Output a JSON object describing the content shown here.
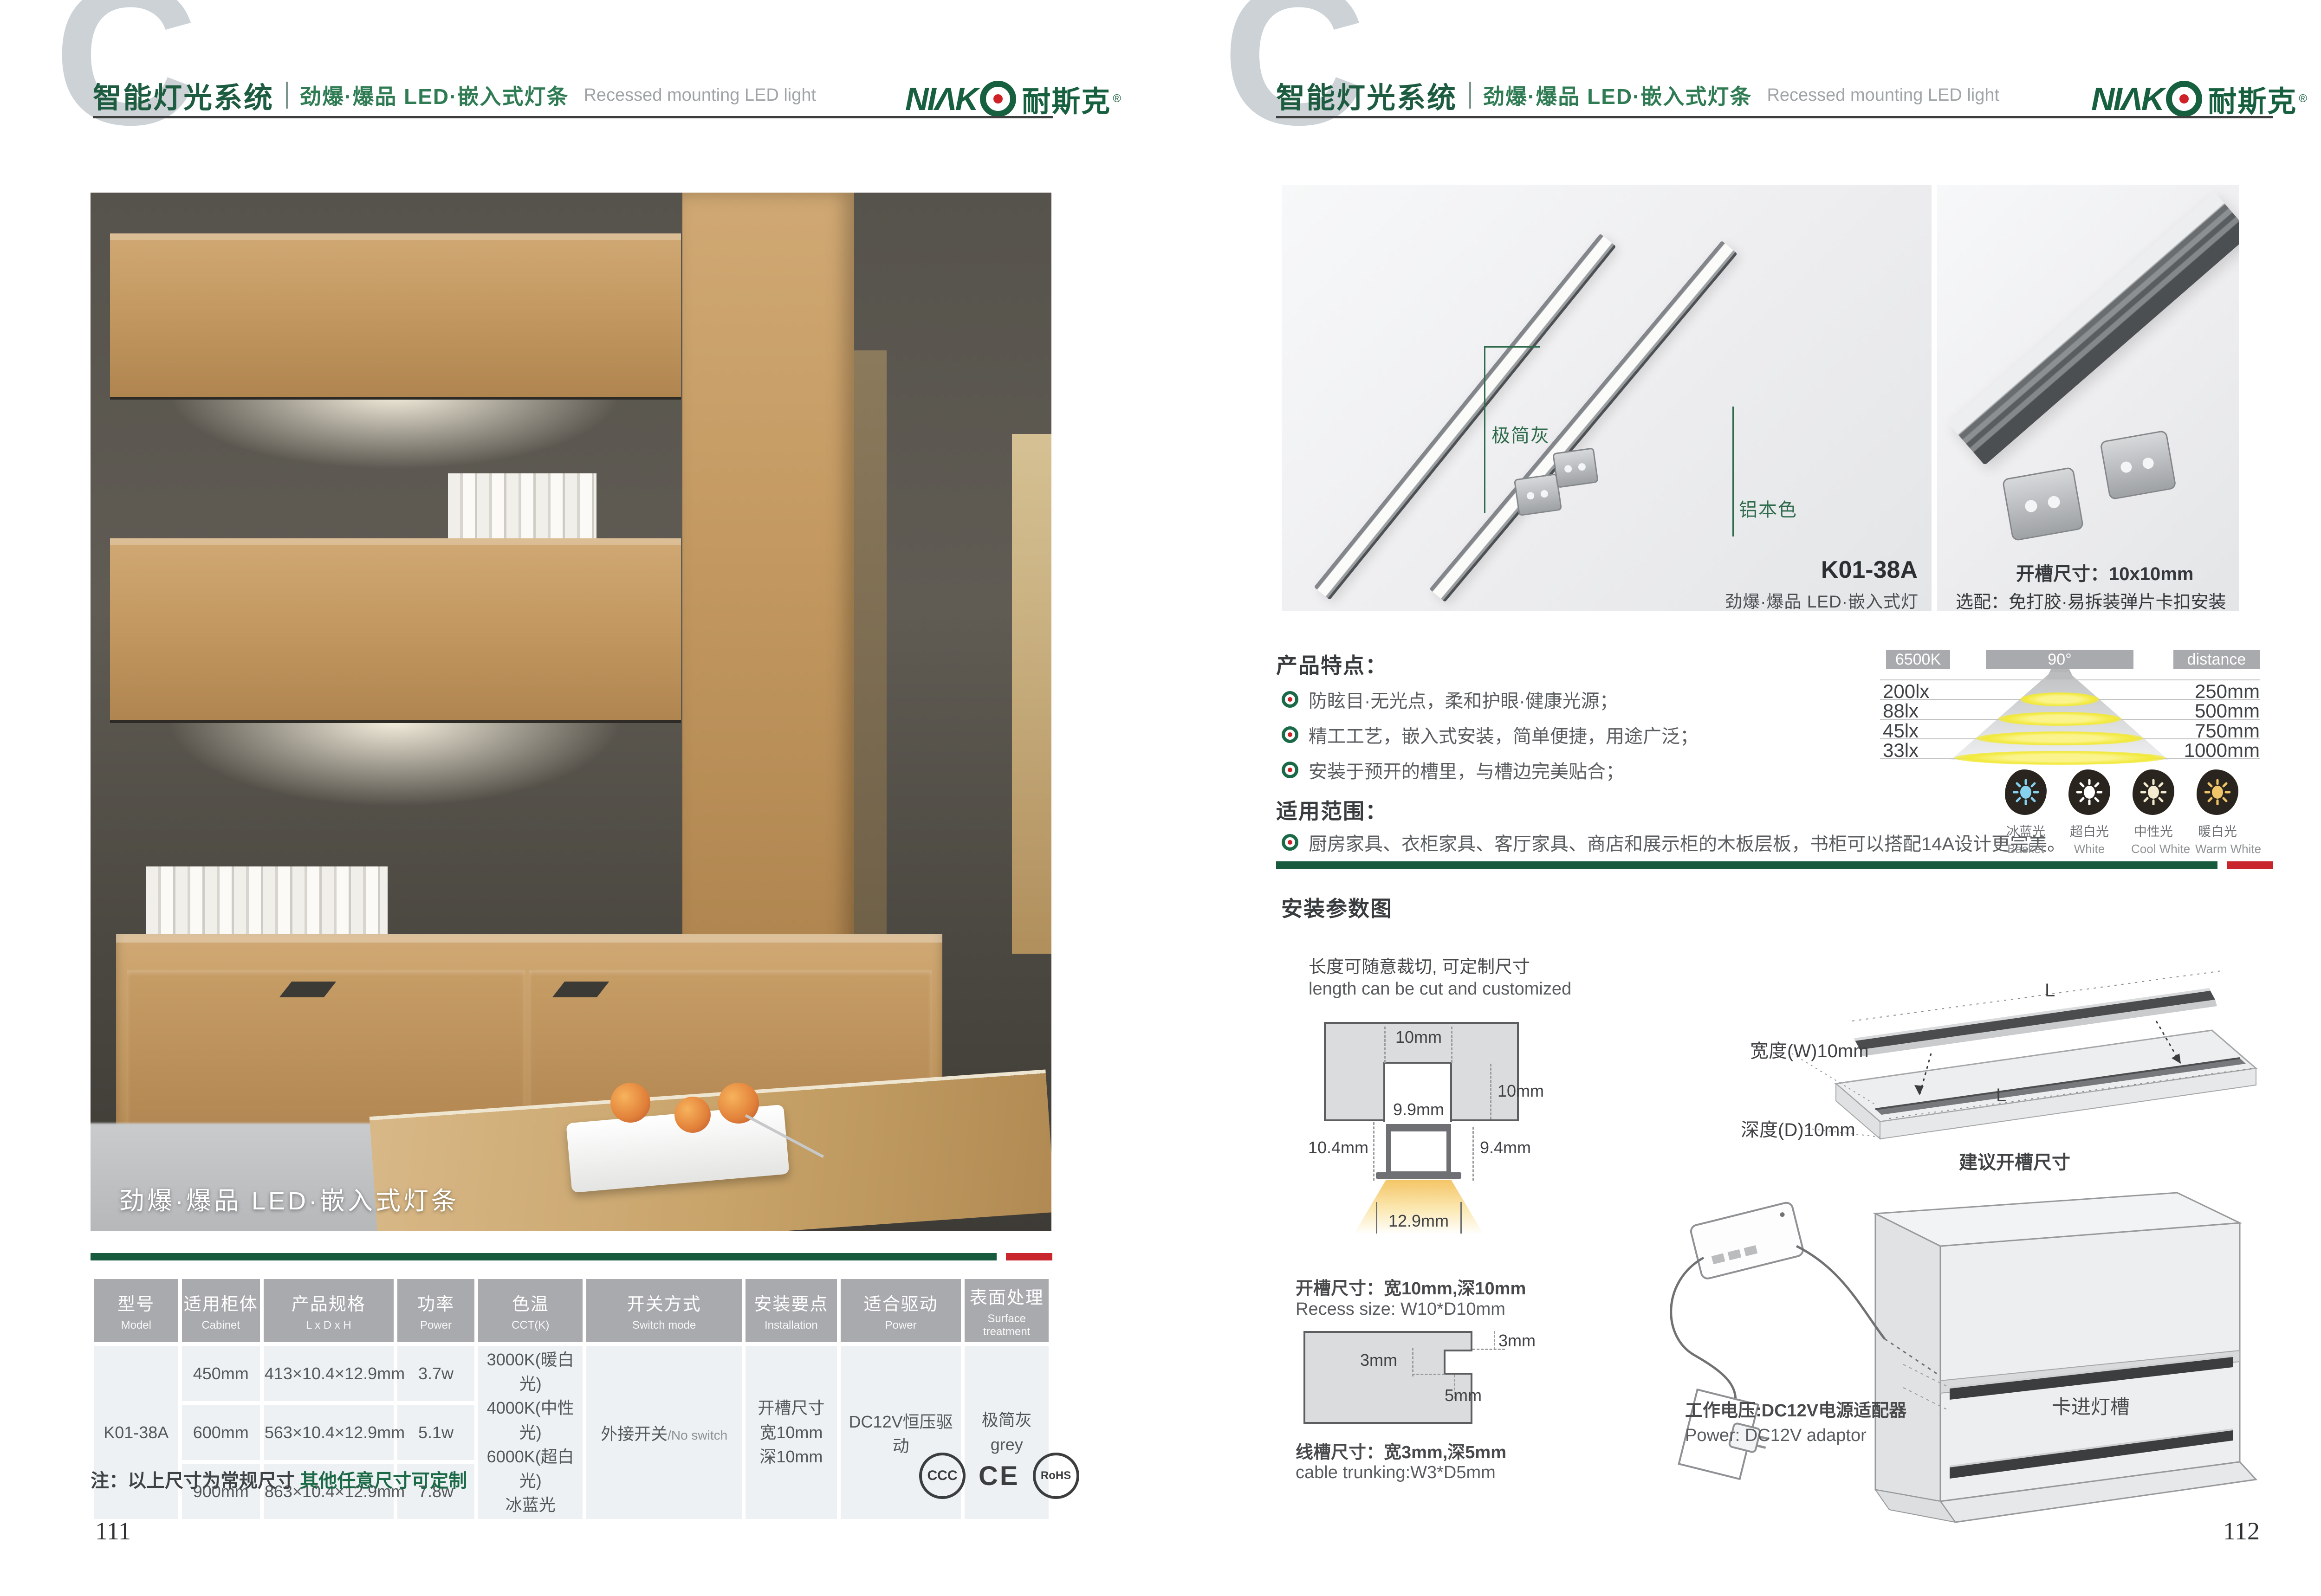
{
  "header": {
    "watermark_letter": "C",
    "title_cn": "智能灯光系统",
    "subtitle_cn": "劲爆·爆品  LED·嵌入式灯条",
    "subtitle_en": "Recessed mounting LED light",
    "brand_latin": "NIΛK",
    "brand_cn": "耐斯克",
    "brand_reg": "®"
  },
  "colors": {
    "brand_green": "#1b6a47",
    "accent_red": "#c9252c",
    "bar_green": "#175a3e",
    "table_header_gray": "#a8aaad"
  },
  "left_page": {
    "page_number": "111",
    "photo_caption": "劲爆·爆品  LED·嵌入式灯条",
    "note_prefix": "注：以上尺寸为常规尺寸 ",
    "note_highlight": "其他任意尺寸可定制",
    "certs": {
      "ccc": "CCC",
      "ce": "CE",
      "rohs": "RoHS"
    },
    "table": {
      "headers": [
        {
          "cn": "型号",
          "en": "Model"
        },
        {
          "cn": "适用柜体",
          "en": "Cabinet"
        },
        {
          "cn": "产品规格",
          "en": "L x D x H"
        },
        {
          "cn": "功率",
          "en": "Power"
        },
        {
          "cn": "色温",
          "en": "CCT(K)"
        },
        {
          "cn": "开关方式",
          "en": "Switch mode"
        },
        {
          "cn": "安装要点",
          "en": "Installation"
        },
        {
          "cn": "适合驱动",
          "en": "Power"
        },
        {
          "cn": "表面处理",
          "en": "Surface treatment"
        }
      ],
      "model": "K01-38A",
      "rows": [
        {
          "cabinet": "450mm",
          "size": "413×10.4×12.9mm",
          "power": "3.7w"
        },
        {
          "cabinet": "600mm",
          "size": "563×10.4×12.9mm",
          "power": "5.1w"
        },
        {
          "cabinet": "900mm",
          "size": "863×10.4×12.9mm",
          "power": "7.8w"
        }
      ],
      "cct_lines": [
        "3000K(暖白光)",
        "4000K(中性光)",
        "6000K(超白光)",
        "冰蓝光"
      ],
      "switch_cn": "外接开关",
      "switch_en": "/No switch",
      "install_lines": [
        "开槽尺寸",
        "宽10mm",
        "深10mm"
      ],
      "driver": "DC12V恒压驱动",
      "surface_cn": "极简灰",
      "surface_en": "grey"
    }
  },
  "right_page": {
    "page_number": "112",
    "photo_main": {
      "label_grey": "极简灰",
      "label_aluminum": "铝本色",
      "model": "K01-38A",
      "caption": "劲爆·爆品  LED·嵌入式灯条"
    },
    "photo_detail": {
      "line1": "开槽尺寸：10x10mm",
      "line2": "选配：免打胶·易拆装弹片卡扣安装"
    },
    "features": {
      "title": "产品特点：",
      "items": [
        "防眩目·无光点，柔和护眼·健康光源；",
        "精工工艺，嵌入式安装，简单便捷，用途广泛；",
        "安装于预开的槽里，与槽边完美贴合；"
      ]
    },
    "scope": {
      "title": "适用范围：",
      "item": "厨房家具、衣柜家具、客厅家具、商店和展示柜的木板层板，书柜可以搭配14A设计更完美。"
    },
    "light_chart": {
      "col_cct": "6500K",
      "col_angle": "90°",
      "col_distance": "distance",
      "rows": [
        {
          "lux": "200lx",
          "distance": "250mm"
        },
        {
          "lux": "88lx",
          "distance": "500mm"
        },
        {
          "lux": "45lx",
          "distance": "750mm"
        },
        {
          "lux": "33lx",
          "distance": "1000mm"
        }
      ]
    },
    "cct_icons": [
      {
        "cn": "冰蓝光",
        "en": "Basket",
        "color": "#86d1ee"
      },
      {
        "cn": "超白光",
        "en": "White",
        "color": "#ffffff"
      },
      {
        "cn": "中性光",
        "en": "Cool White",
        "color": "#f4ead0"
      },
      {
        "cn": "暖白光",
        "en": "Warm White",
        "color": "#f0c468"
      }
    ],
    "install": {
      "title": "安装参数图",
      "cut_cn": "长度可随意裁切, 可定制尺寸",
      "cut_en": "length can be cut and customized",
      "cross_section": {
        "top_width": "10mm",
        "depth": "10mm",
        "inner_width": "9.9mm",
        "left_h": "10.4mm",
        "right_h": "9.4mm",
        "bottom_w": "12.9mm"
      },
      "recess_cn": "开槽尺寸：宽10mm,深10mm",
      "recess_en": "Recess size: W10*D10mm",
      "trunking": {
        "top": "3mm",
        "left": "3mm",
        "bottom": "5mm",
        "cn": "线槽尺寸：宽3mm,深5mm",
        "en": "cable trunking:W3*D5mm"
      },
      "board": {
        "l_top": "L",
        "l_groove": "L",
        "width_label": "宽度(W)10mm",
        "depth_label": "深度(D)10mm",
        "caption": "建议开槽尺寸"
      },
      "power_cn": "工作电压:DC12V电源适配器",
      "power_en": "Power: DC12V adaptor",
      "clip_label": "卡进灯槽"
    }
  }
}
